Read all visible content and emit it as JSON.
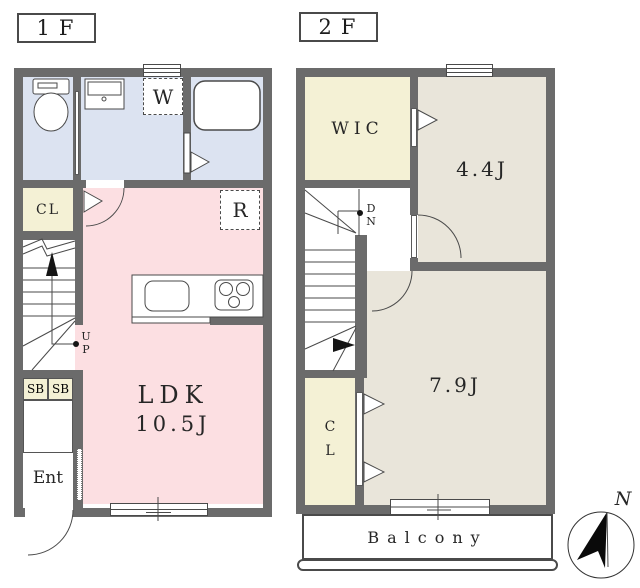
{
  "floor1": {
    "title": "1F",
    "rooms": {
      "ldk_name": "LDK",
      "ldk_area": "10.5J",
      "closet": "CL",
      "entrance": "Ent",
      "shoe_box_a": "SB",
      "shoe_box_b": "SB",
      "washing_machine": "W",
      "refrigerator": "R"
    },
    "stairs_direction": "UP"
  },
  "floor2": {
    "title": "2F",
    "rooms": {
      "walk_in_closet": "WIC",
      "bedroom_small_area": "4.4J",
      "bedroom_large_area": "7.9J",
      "closet": "CL"
    },
    "stairs_direction": "DN",
    "balcony": "Balcony"
  },
  "compass": {
    "north": "N"
  },
  "colors": {
    "wall": "#6b6b6b",
    "wet_area": "#dce3f1",
    "ldk": "#fcdfe2",
    "storage": "#f4f1d5",
    "bedroom": "#e9e5da"
  }
}
